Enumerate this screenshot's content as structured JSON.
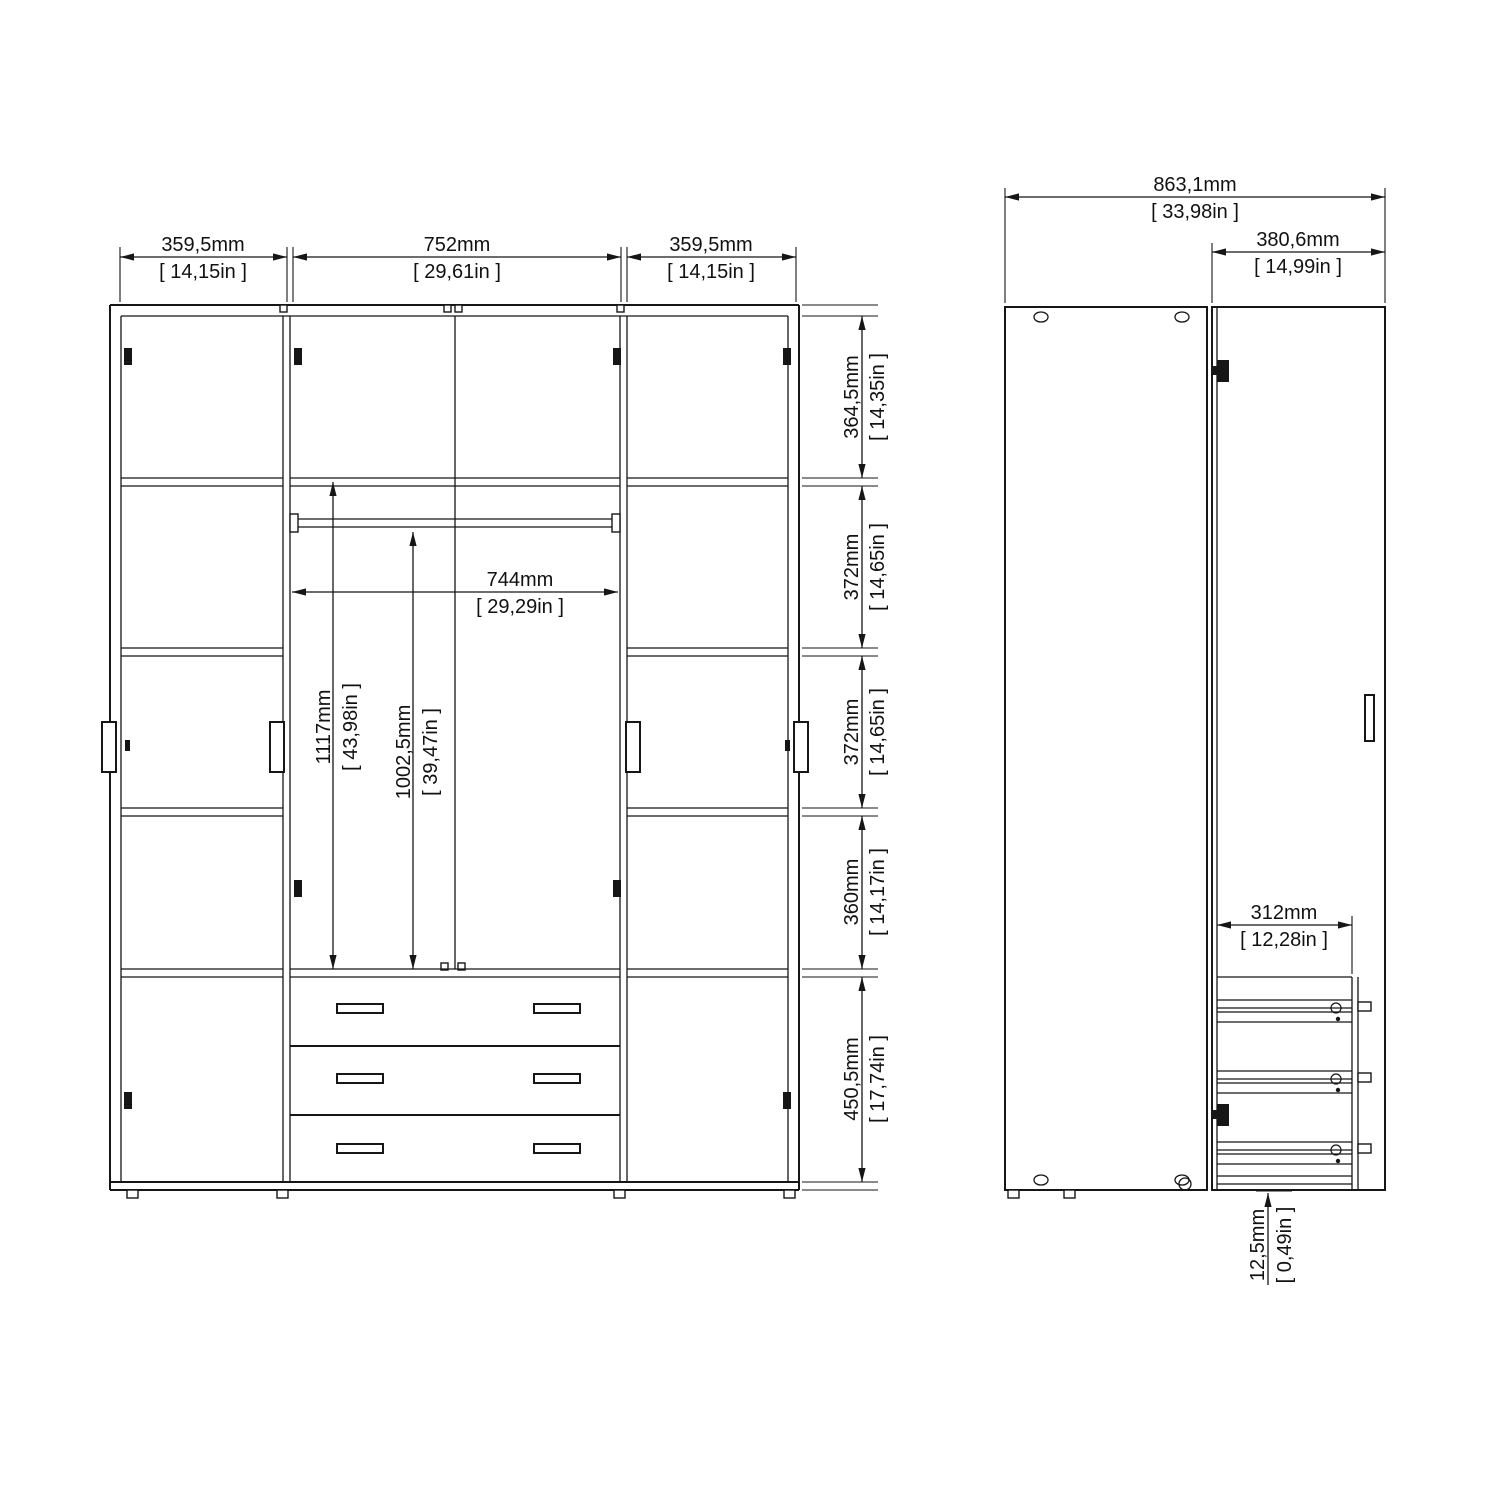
{
  "drawing": {
    "type": "wardrobe technical drawing, front and side views",
    "line_color": "#161616",
    "background_color": "#ffffff"
  },
  "front_view": {
    "top_widths": [
      {
        "mm": "359,5mm",
        "in": "[ 14,15in ]"
      },
      {
        "mm": "752mm",
        "in": "[ 29,61in ]"
      },
      {
        "mm": "359,5mm",
        "in": "[ 14,15in ]"
      }
    ],
    "right_heights": [
      {
        "mm": "364,5mm",
        "in": "[ 14,35in ]"
      },
      {
        "mm": "372mm",
        "in": "[ 14,65in ]"
      },
      {
        "mm": "372mm",
        "in": "[ 14,65in ]"
      },
      {
        "mm": "360mm",
        "in": "[ 14,17in ]"
      },
      {
        "mm": "450,5mm",
        "in": "[ 17,74in ]"
      }
    ],
    "interior": {
      "rail_width": {
        "mm": "744mm",
        "in": "[ 29,29in ]"
      },
      "left_height": {
        "mm": "1117mm",
        "in": "[ 43,98in ]"
      },
      "hang_height": {
        "mm": "1002,5mm",
        "in": "[ 39,47in ]"
      }
    }
  },
  "side_view": {
    "total_depth": {
      "mm": "863,1mm",
      "in": "[ 33,98in ]"
    },
    "door_width": {
      "mm": "380,6mm",
      "in": "[ 14,99in ]"
    },
    "drawer_depth": {
      "mm": "312mm",
      "in": "[ 12,28in ]"
    },
    "foot_height": {
      "mm": "12,5mm",
      "in": "[ 0,49in ]"
    }
  }
}
